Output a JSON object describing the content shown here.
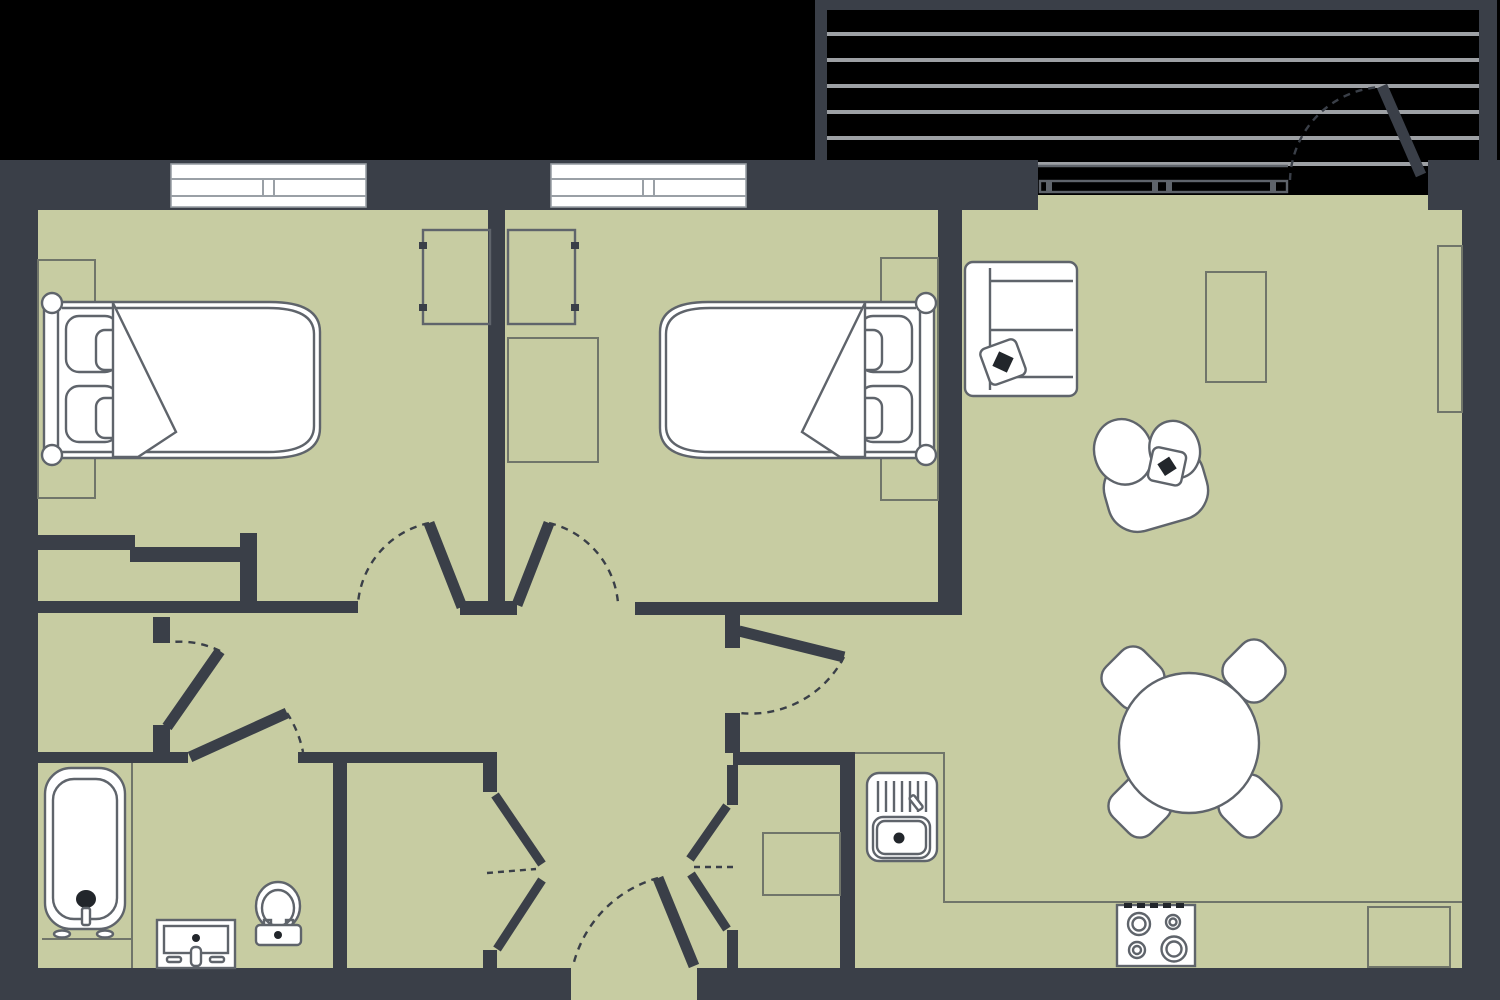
{
  "title": "apartment-floor-plan",
  "colors": {
    "background": "#000000",
    "wall": "#3a3f48",
    "floor": "#c7cca2",
    "furniture_fill": "#ffffff",
    "outline": "#5f646b",
    "thin": "#70756a",
    "slat": "#9da0a4",
    "window_line": "#9aa0a6",
    "accent": "#22262b"
  },
  "floor_plan": {
    "type": "apartment",
    "style": "top-down architectural drawing, dark walls on black background, sage-green floors, white furniture symbols",
    "rooms": [
      {
        "name": "bedroom-1",
        "position": "top-left",
        "windows": 1,
        "furniture": [
          "double-bed-headboard-left",
          "two-pillows",
          "folded-blanket",
          "bedside-rug",
          "wardrobe"
        ]
      },
      {
        "name": "bedroom-2",
        "position": "top-middle",
        "windows": 1,
        "furniture": [
          "double-bed-headboard-right",
          "two-pillows",
          "folded-blanket",
          "bedside-rug",
          "wardrobe",
          "desk"
        ]
      },
      {
        "name": "living-dining-room",
        "position": "right",
        "furniture": [
          "sofa-with-throw-pillow",
          "armchair-with-throw-pillow",
          "coffee-table",
          "tv-sideboard",
          "round-dining-table",
          "four-dining-chairs"
        ]
      },
      {
        "name": "kitchen-corner",
        "position": "bottom-right",
        "furniture": [
          "counter-l-shaped",
          "sink-with-drainer-and-tap",
          "stove-four-burners",
          "fridge-or-counter-end"
        ]
      },
      {
        "name": "bathroom",
        "position": "bottom-left",
        "furniture": [
          "bathtub-with-tap-and-feet",
          "washbasin-vanity-with-drawers",
          "toilet-with-cistern"
        ]
      },
      {
        "name": "storage-room",
        "position": "bottom-center-left",
        "furniture": []
      },
      {
        "name": "utility-closet",
        "position": "bottom-center-right",
        "furniture": [
          "appliance-box"
        ]
      },
      {
        "name": "hallway",
        "position": "center",
        "furniture": []
      },
      {
        "name": "balcony",
        "position": "top-right",
        "features": [
          "decking-slats",
          "railing-frame",
          "hinged-balcony-door",
          "sliding-glazing-track"
        ]
      }
    ],
    "doors": [
      {
        "name": "bedroom-1-door",
        "type": "hinged",
        "swing": "into-bedroom-1"
      },
      {
        "name": "bedroom-2-door",
        "type": "hinged",
        "swing": "into-bedroom-2"
      },
      {
        "name": "living-room-door",
        "type": "hinged",
        "swing": "into-living-room"
      },
      {
        "name": "bathroom-door",
        "type": "hinged",
        "swing": "into-hallway"
      },
      {
        "name": "inner-hall-door",
        "type": "hinged",
        "swing": "into-hallway"
      },
      {
        "name": "storage-folding-door",
        "type": "bifold"
      },
      {
        "name": "utility-folding-door",
        "type": "bifold"
      },
      {
        "name": "entrance-door",
        "type": "hinged",
        "swing": "inward",
        "position": "bottom-center"
      },
      {
        "name": "balcony-door",
        "type": "hinged",
        "swing": "onto-balcony"
      }
    ],
    "windows": [
      {
        "name": "bedroom-1-window",
        "wall": "top"
      },
      {
        "name": "bedroom-2-window",
        "wall": "top"
      }
    ]
  }
}
